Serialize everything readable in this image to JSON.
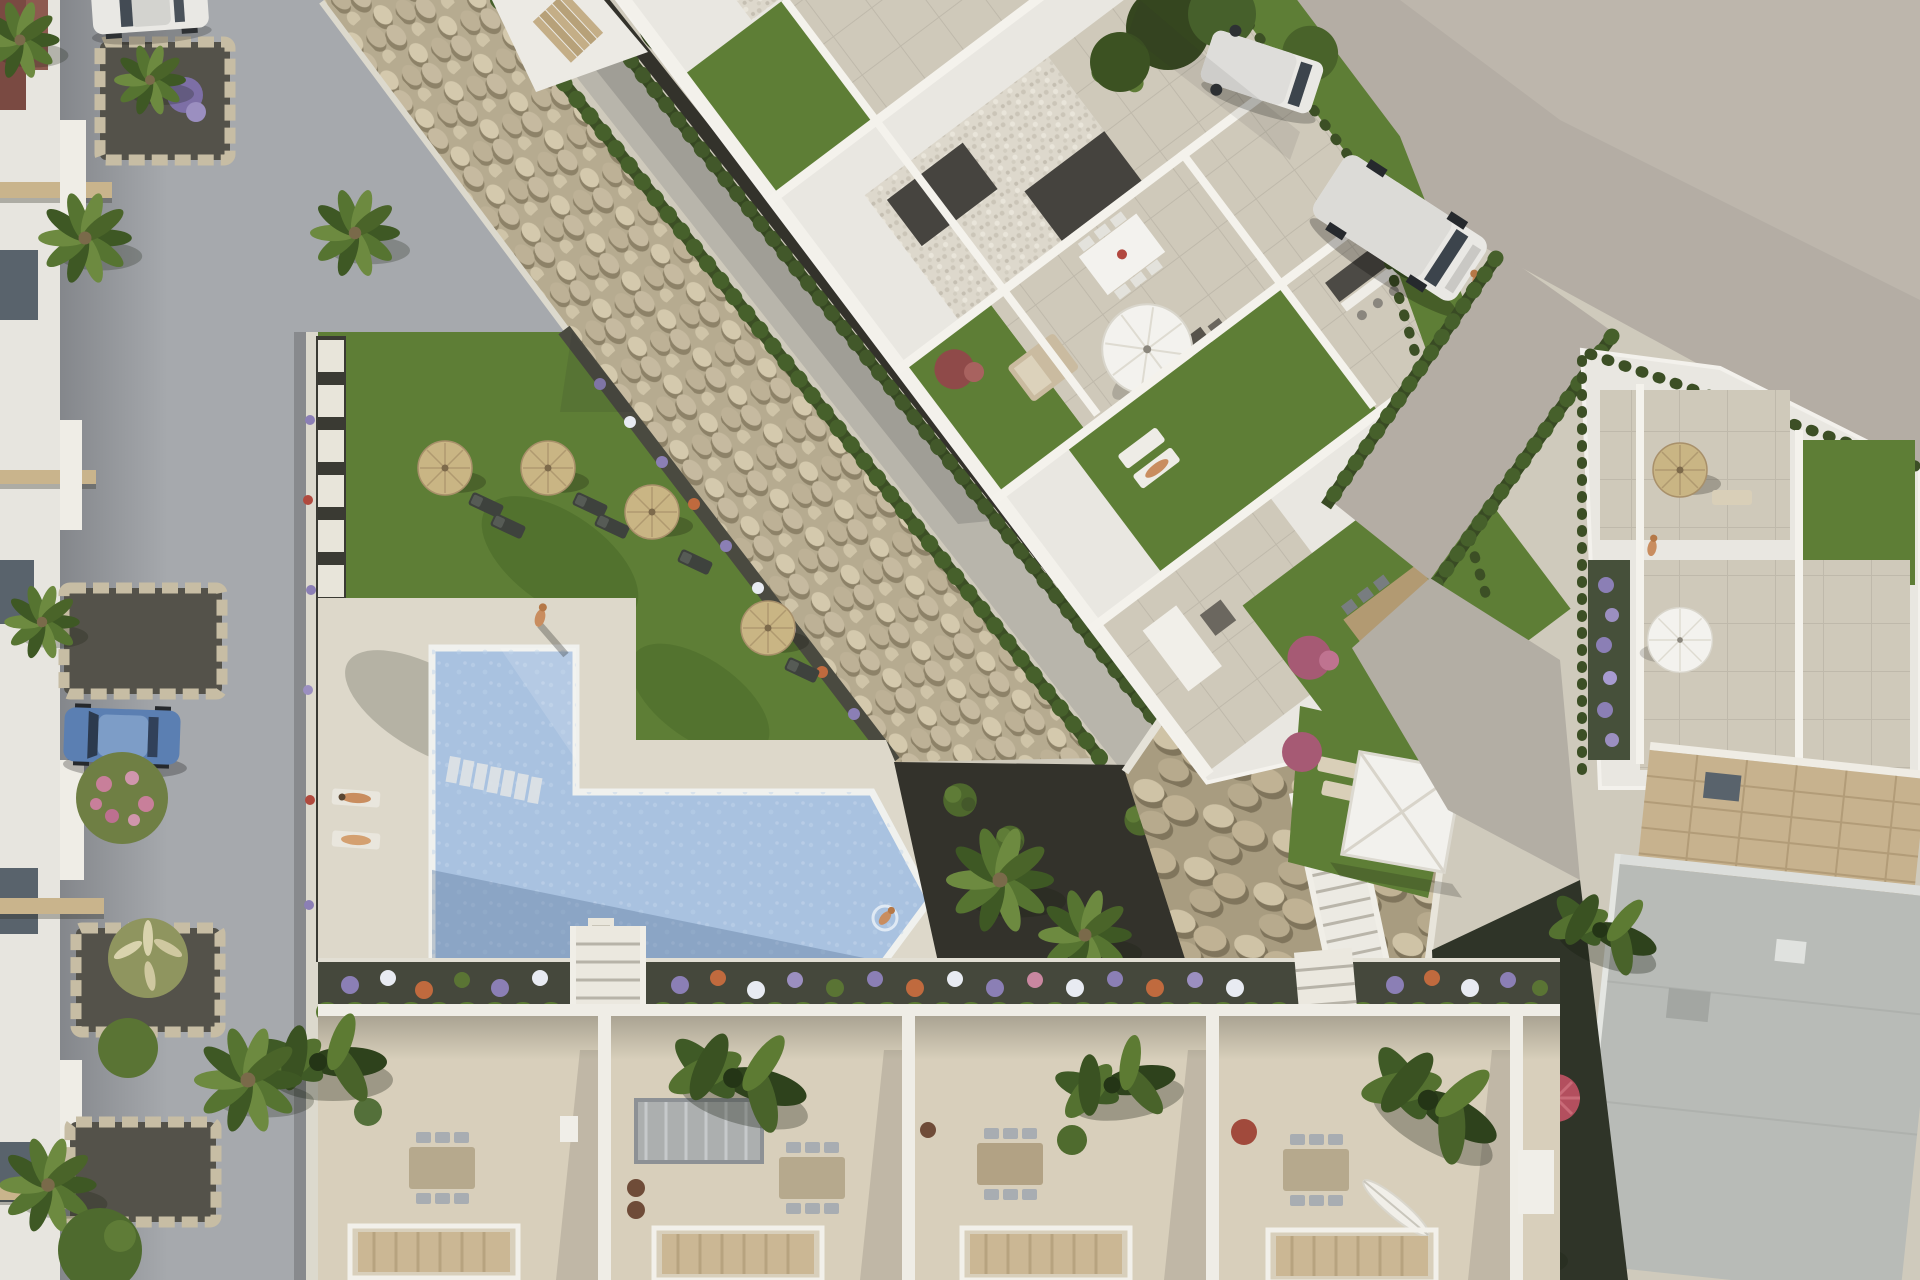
{
  "scene": {
    "type": "aerial-architectural-render",
    "description": "Top-down 3D rendering of a modern white residential complex with rooftop garden terraces, a communal lawn with straw parasols and sun loungers, an L-shaped swimming pool with sun deck, a diagonal river-stone landscaping bank with hedge-lined walkway, a row of townhouse patios with pergolas, streets with parked cars and vans, and lush palm vegetation.",
    "time_of_day": "daytime",
    "people_visible": 6,
    "vehicles": {
      "parked_cars": 2,
      "vans": 2
    },
    "amenities": [
      "swimming-pool",
      "sun-deck",
      "communal-garden",
      "straw-parasols",
      "white-parasol",
      "sun-loungers",
      "rooftop-terraces",
      "private-lawns",
      "pergola-patios",
      "stone-landscaping",
      "outdoor-dining-sets"
    ]
  },
  "palette": {
    "street": "#a6a9ad",
    "road": "#b4ada4",
    "roadLight": "#c1b9af",
    "pavement": "#cfcabc",
    "houseWhite": "#e7e5df",
    "wallWhite": "#efede6",
    "buildingWhite": "#e9e7e1",
    "canopyBeige": "#c9b48c",
    "windowDark": "#59636c",
    "gravelBed": "#54524a",
    "stoneBg": "#b6ab90",
    "rockBg": "#a89c80",
    "walkway": "#b8b5ab",
    "hedge": "#3c4f25",
    "soil": "#33322b",
    "lawn": "#5e7e36",
    "tileBase": "#cfc9ba",
    "gravelWhiteBase": "#ddd8cc",
    "roofDark": "#46443f",
    "parasolStraw": "#c9b584",
    "parasolWhite": "#f3f2ee",
    "deck": "#ddd8ca",
    "poolWater": "#a9c2e0",
    "waterDeep": "#7e9cc0",
    "bedSoil": "#45483c",
    "hedgeRow": "#4a6129",
    "terraceFloor": "#d8cfbb",
    "pergolaBeige": "#cbb794",
    "brick": "#c7b28e",
    "roofGray": "#b8bbb7",
    "gardenDark": "#2f3428",
    "shrubRed": "#8f4a49",
    "shrubPink": "#a65a74",
    "flowerPurple": "#8b7fb5",
    "flowerWhite": "#e8ebf2",
    "flowerOrange": "#c06a3e",
    "skin": "#c98d5f",
    "woodTable": "#b29a72",
    "carBlue": "#5b7fb2",
    "vehicleWhite": "#e9e8e4"
  },
  "objects": [
    {
      "name": "left-street",
      "label": "residential street with parked cars"
    },
    {
      "name": "left-townhouses",
      "label": "townhouse facades with beige canopies"
    },
    {
      "name": "stone-bank",
      "label": "diagonal river-stone landscaping band"
    },
    {
      "name": "walkway",
      "label": "hedge-lined concrete walkway"
    },
    {
      "name": "main-building",
      "label": "white apartment block with terraces and lawns"
    },
    {
      "name": "pool-garden",
      "label": "communal lawn with straw parasols"
    },
    {
      "name": "swimming-pool",
      "label": "L-shaped swimming pool with deck"
    },
    {
      "name": "flower-bed-strip",
      "label": "flower bed with hedge above patios"
    },
    {
      "name": "townhouse-patios",
      "label": "row of patios with pergolas and dining sets"
    },
    {
      "name": "upper-road",
      "label": "beige access road with vans"
    },
    {
      "name": "right-building",
      "label": "neighbouring white building with terrace"
    },
    {
      "name": "gray-roof-building",
      "label": "flat gray roof building"
    },
    {
      "name": "rock-slope",
      "label": "boulder slope with white staircase"
    }
  ]
}
